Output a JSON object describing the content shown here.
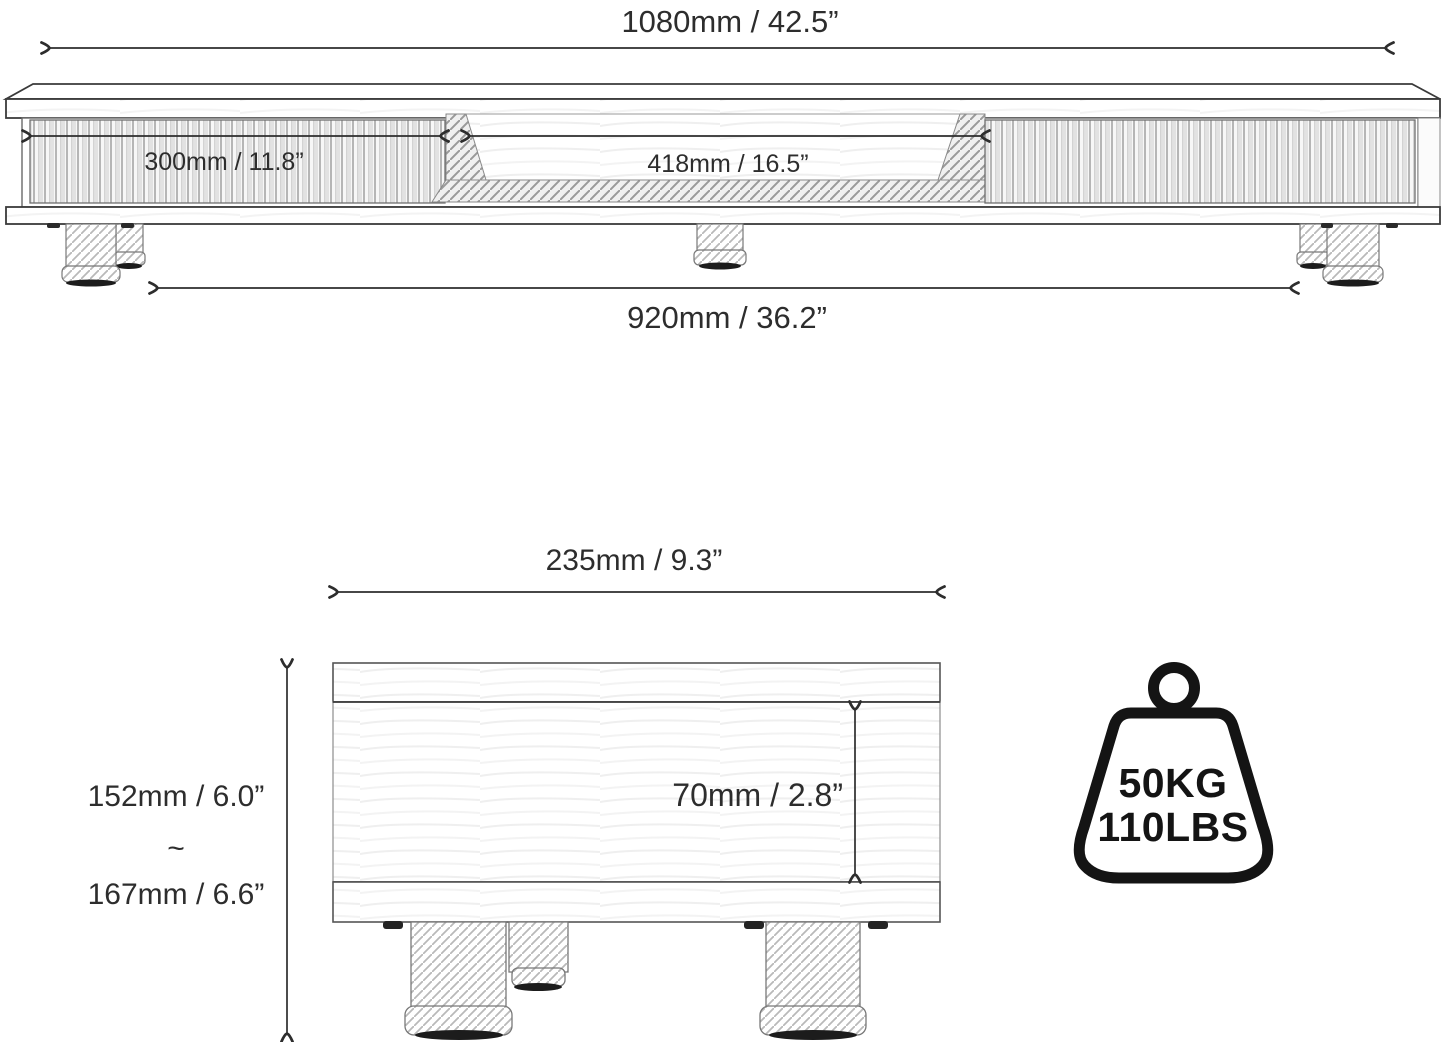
{
  "front_view": {
    "overall_width_label": "1080mm / 42.5”",
    "drawer_width_label": "300mm / 11.8”",
    "opening_width_label": "418mm / 16.5”",
    "leg_span_label": "920mm / 36.2”"
  },
  "side_view": {
    "depth_label": "235mm / 9.3”",
    "height_min_label": "152mm / 6.0”",
    "height_range_separator": "~",
    "height_max_label": "167mm / 6.6”",
    "inner_height_label": "70mm / 2.8”"
  },
  "weight_capacity": {
    "kilograms_label": "50KG",
    "pounds_label": "110LBS"
  },
  "colors": {
    "line": "#2d2d2d",
    "background": "#ffffff"
  }
}
